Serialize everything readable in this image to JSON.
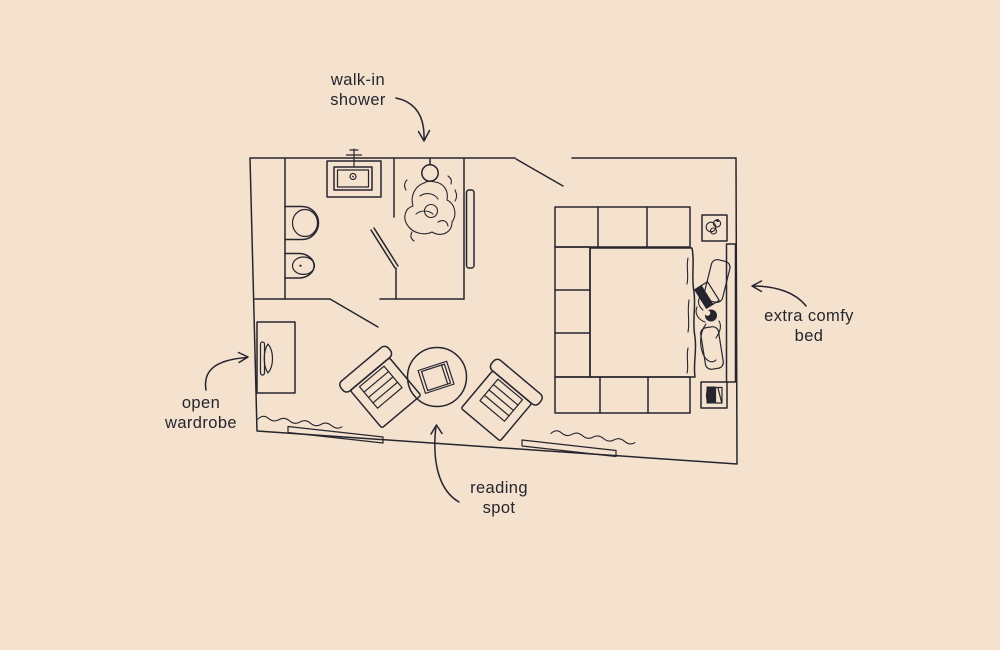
{
  "colors": {
    "background": "#f4e2ce",
    "ink": "#26252e"
  },
  "annotations": {
    "shower": {
      "text": "walk-in\nshower"
    },
    "bed": {
      "text": "extra comfy\nbed"
    },
    "wardrobe": {
      "text": "open\nwardrobe"
    },
    "reading": {
      "text": "reading\nspot"
    }
  },
  "floor_plan": {
    "type": "hand-drawn room floor plan",
    "areas": [
      "bathroom",
      "walk-in shower",
      "bedroom",
      "reading spot",
      "wardrobe nook"
    ],
    "furniture_icons": [
      "sink-icon",
      "faucet-icon",
      "toilet-icon",
      "bidet-icon",
      "shower-head-icon",
      "person-showering-icon",
      "wardrobe-hanger-icon",
      "armchair-icon",
      "round-table-icon",
      "book-icon",
      "bed-platform-icon",
      "mattress-icon",
      "pillow-icon",
      "person-reading-icon",
      "headboard-icon",
      "plant-nightstand-icon",
      "books-nightstand-icon",
      "window-sill-icon",
      "curtain-icon",
      "entry-door-icon"
    ]
  }
}
